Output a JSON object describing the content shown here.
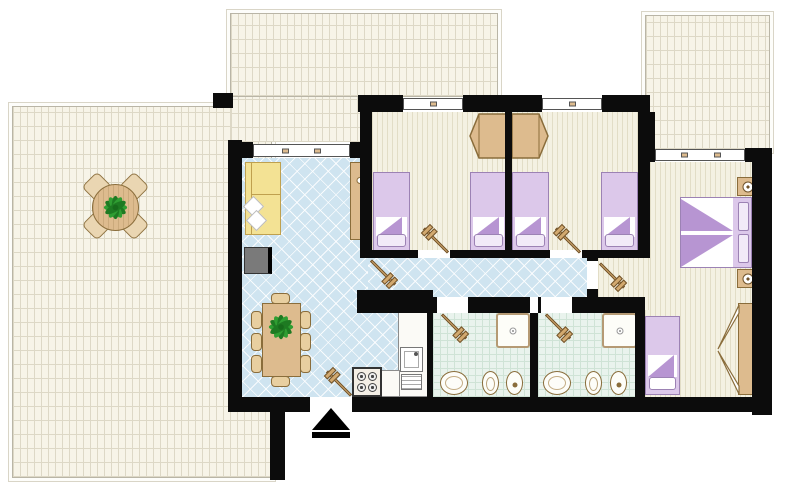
{
  "meta": {
    "view": "apartment-floor-plan-2d",
    "orientation": "top-down"
  },
  "theme": {
    "wall": "#0c0c0c",
    "terraceFloor": "#f7f4e8",
    "terraceLine": "#ddd8c6",
    "tileBlue": "#cfe4f0",
    "woodFloor": "#f4f1e2",
    "woodLine": "#e2ddc6",
    "bathFloor": "#e9f3ed",
    "bathLine": "#cfe3d6",
    "bedLilac": "#dcc8ea",
    "bedLilacDark": "#b795d2",
    "bedBorder": "#9c82b4",
    "wood": "#ddbb8e",
    "woodBorder": "#8a6d3b",
    "sofaYellow": "#f3e294",
    "sofaBorder": "#bfa04e",
    "tvGray": "#7a7a7a",
    "plantGreen": "#2f9e32",
    "plantGreenDark": "#1e7a22"
  },
  "rooms": [
    {
      "id": "terrace-left",
      "label": "terrace"
    },
    {
      "id": "terrace-top",
      "label": "terrace"
    },
    {
      "id": "terrace-right",
      "label": "terrace"
    },
    {
      "id": "living-kitchen",
      "label": "living-dining-with-kitchenette"
    },
    {
      "id": "hallway",
      "label": "hallway"
    },
    {
      "id": "bedroom-1",
      "label": "twin-bedroom"
    },
    {
      "id": "bedroom-2",
      "label": "twin-bedroom"
    },
    {
      "id": "master-bedroom",
      "label": "bedroom-double-plus-single"
    },
    {
      "id": "bathroom-1",
      "label": "bathroom-with-shower"
    },
    {
      "id": "bathroom-2",
      "label": "bathroom-with-shower"
    }
  ],
  "furniture_counts": {
    "single_beds": 5,
    "double_beds": 1,
    "wardrobes": 3,
    "nightstands": 2,
    "sofas": 1,
    "tv_units": 1,
    "sideboards": 1,
    "dining_tables": 1,
    "dining_chairs": 8,
    "terrace_tables": 1,
    "terrace_chairs": 4,
    "stoves": 1,
    "kitchen_sinks": 1,
    "showers": 2,
    "washbasins": 2,
    "toilets": 2,
    "bidets": 2,
    "interior_doors": 6,
    "entrance_doors": 1,
    "windows": 4,
    "plants": 2
  }
}
